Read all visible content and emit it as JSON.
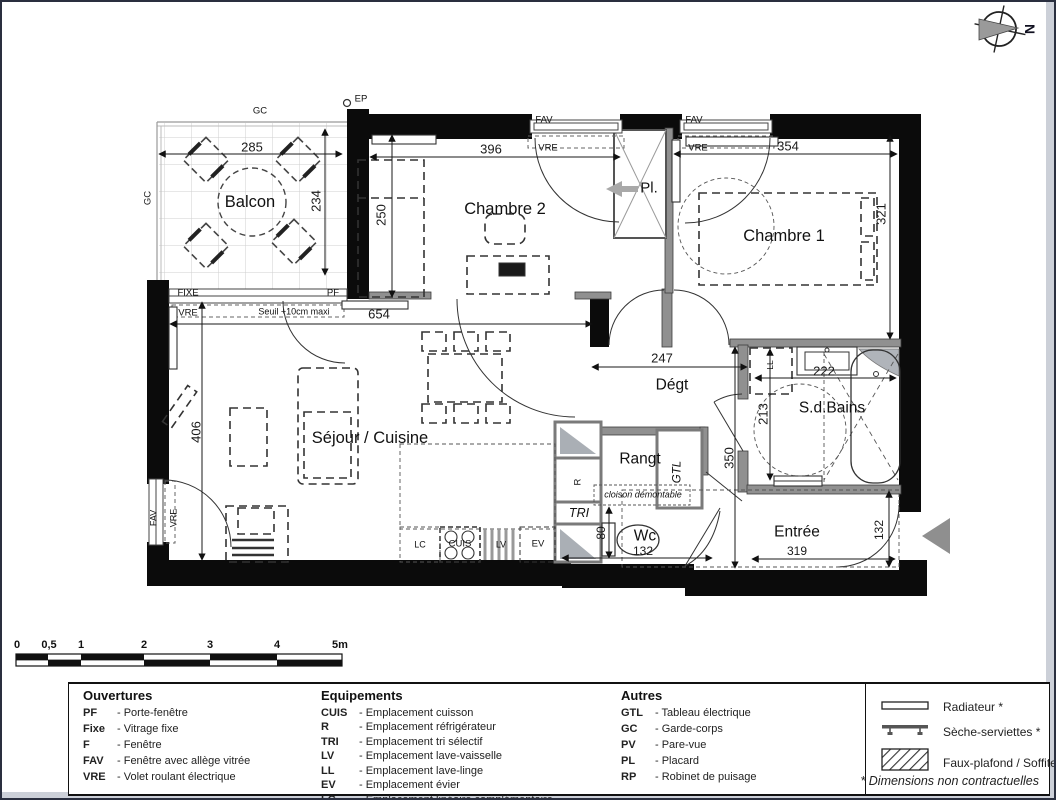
{
  "compass": {
    "north": "N"
  },
  "plan": {
    "balcon": "Balcon",
    "chambre2": "Chambre 2",
    "chambre1": "Chambre 1",
    "placard": "Pl.",
    "sejour_cuisine": "Séjour / Cuisine",
    "degagement": "Dégt",
    "rangement": "Rangt",
    "gtl": "GTL",
    "salle_de_bains": "S.d.Bains",
    "wc": "Wc",
    "entree": "Entrée",
    "tri": "TRI",
    "refrigerateur": "R",
    "lc": "LC",
    "cuis": "CUIS",
    "lv": "LV",
    "ev": "EV",
    "ll": "LL",
    "ep": "EP",
    "gc_top": "GC",
    "gc_left": "GC",
    "fixe": "FIXE",
    "pf": "PF",
    "vre": "VRE",
    "fav": "FAV",
    "seuil": "Seuil +10cm maxi",
    "cloison": "cloison démontable"
  },
  "dims": {
    "balcon_w": "285",
    "balcon_h": "234",
    "chambre2_w": "396",
    "chambre2_h": "250",
    "chambre1_w": "354",
    "chambre1_h": "321",
    "sejour_w": "654",
    "sejour_h": "406",
    "degt_w": "247",
    "couloir_h": "350",
    "sdb_w": "222",
    "sdb_h": "213",
    "wc_w": "132",
    "wc_h": "80",
    "entree_w": "319",
    "entree_h": "132"
  },
  "scale_bar": {
    "ticks": [
      "0",
      "0,5",
      "1",
      "2",
      "3",
      "4",
      "5m"
    ]
  },
  "legend": {
    "ouvertures": {
      "title": "Ouvertures",
      "items": [
        {
          "abbr": "PF",
          "desc": "- Porte-fenêtre"
        },
        {
          "abbr": "Fixe",
          "desc": "- Vitrage fixe"
        },
        {
          "abbr": "F",
          "desc": "- Fenêtre"
        },
        {
          "abbr": "FAV",
          "desc": "- Fenêtre avec allège vitrée"
        },
        {
          "abbr": "VRE",
          "desc": "- Volet roulant électrique"
        }
      ]
    },
    "equipements": {
      "title": "Equipements",
      "items": [
        {
          "abbr": "CUIS",
          "desc": "- Emplacement cuisson"
        },
        {
          "abbr": "R",
          "desc": "- Emplacement réfrigérateur"
        },
        {
          "abbr": "TRI",
          "desc": "- Emplacement tri sélectif"
        },
        {
          "abbr": "LV",
          "desc": "- Emplacement lave-vaisselle"
        },
        {
          "abbr": "LL",
          "desc": "- Emplacement lave-linge"
        },
        {
          "abbr": "EV",
          "desc": "- Emplacement évier"
        },
        {
          "abbr": "LC",
          "desc": "- Emplacement linéaire complémentaire"
        }
      ]
    },
    "autres": {
      "title": "Autres",
      "items": [
        {
          "abbr": "GTL",
          "desc": "- Tableau électrique"
        },
        {
          "abbr": "GC",
          "desc": "- Garde-corps"
        },
        {
          "abbr": "PV",
          "desc": "- Pare-vue"
        },
        {
          "abbr": "PL",
          "desc": "- Placard"
        },
        {
          "abbr": "RP",
          "desc": "- Robinet de puisage"
        }
      ]
    },
    "symbols": {
      "items": [
        {
          "label": "Radiateur *"
        },
        {
          "label": "Sèche-serviettes *"
        },
        {
          "label": "Faux-plafond / Soffite"
        }
      ],
      "note": "* Dimensions non contractuelles"
    }
  }
}
